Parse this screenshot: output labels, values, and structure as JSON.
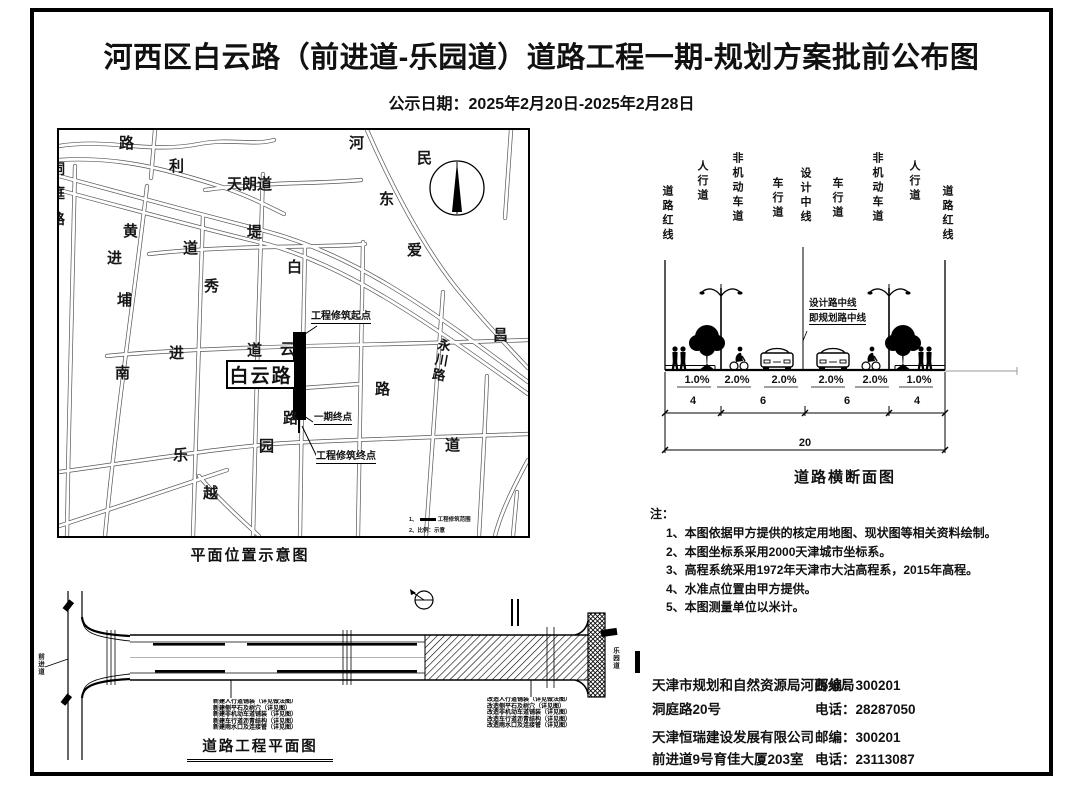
{
  "page": {
    "title": "河西区白云路（前进道-乐园道）道路工程一期-规划方案批前公布图",
    "publish_date": "公示日期：2025年2月20日-2025年2月28日"
  },
  "map": {
    "caption": "平面位置示意图",
    "highlight_label": "白云路",
    "start_label": "工程修筑起点",
    "phase1_end_label": "一期终点",
    "end_label": "工程修筑终点",
    "legend_no1": "1、",
    "legend_line1": "工程修筑范围",
    "legend_line2": "2、比例：示意",
    "vertical_road": "永川路",
    "street_chars": [
      {
        "t": "路",
        "x": 60,
        "y": 6
      },
      {
        "t": "利",
        "x": 110,
        "y": 29
      },
      {
        "t": "河",
        "x": 290,
        "y": 6
      },
      {
        "t": "民",
        "x": 358,
        "y": 21
      },
      {
        "t": "天朗道",
        "x": 168,
        "y": 47
      },
      {
        "t": "东",
        "x": 320,
        "y": 62
      },
      {
        "t": "黄",
        "x": 64,
        "y": 94
      },
      {
        "t": "堤",
        "x": 188,
        "y": 95
      },
      {
        "t": "道",
        "x": 124,
        "y": 111
      },
      {
        "t": "进",
        "x": 48,
        "y": 121
      },
      {
        "t": "白",
        "x": 228,
        "y": 130
      },
      {
        "t": "爱",
        "x": 348,
        "y": 113
      },
      {
        "t": "秀",
        "x": 145,
        "y": 149
      },
      {
        "t": "埔",
        "x": 58,
        "y": 163
      },
      {
        "t": "道",
        "x": 188,
        "y": 213
      },
      {
        "t": "云",
        "x": 221,
        "y": 212
      },
      {
        "t": "进",
        "x": 110,
        "y": 216
      },
      {
        "t": "南",
        "x": 56,
        "y": 236
      },
      {
        "t": "路",
        "x": 316,
        "y": 252
      },
      {
        "t": "昌",
        "x": 434,
        "y": 198
      },
      {
        "t": "路",
        "x": 224,
        "y": 281
      },
      {
        "t": "园",
        "x": 200,
        "y": 309
      },
      {
        "t": "乐",
        "x": 114,
        "y": 318
      },
      {
        "t": "道",
        "x": 386,
        "y": 308
      },
      {
        "t": "越",
        "x": 144,
        "y": 356
      }
    ],
    "clipped_chars": [
      {
        "t": "洞",
        "x": -8,
        "y": 32
      },
      {
        "t": "庭",
        "x": -8,
        "y": 56
      },
      {
        "t": "路",
        "x": -8,
        "y": 82
      }
    ]
  },
  "cross_section": {
    "caption": "道路横断面图",
    "lane_labels": [
      {
        "t": "道路红线",
        "x": 13,
        "y": 50
      },
      {
        "t": "人行道",
        "x": 48,
        "y": 25
      },
      {
        "t": "非机动车道",
        "x": 83,
        "y": 17
      },
      {
        "t": "车行道",
        "x": 123,
        "y": 42
      },
      {
        "t": "设计中线",
        "x": 151,
        "y": 32
      },
      {
        "t": "车行道",
        "x": 183,
        "y": 42
      },
      {
        "t": "非机动车道",
        "x": 223,
        "y": 17
      },
      {
        "t": "人行道",
        "x": 260,
        "y": 25
      },
      {
        "t": "道路红线",
        "x": 293,
        "y": 50
      }
    ],
    "centerline_note_1": "设计路中线",
    "centerline_note_2": "即规划路中线",
    "slopes": [
      {
        "t": "1.0%",
        "x": 32
      },
      {
        "t": "2.0%",
        "x": 72
      },
      {
        "t": "2.0%",
        "x": 119
      },
      {
        "t": "2.0%",
        "x": 166
      },
      {
        "t": "2.0%",
        "x": 210
      },
      {
        "t": "1.0%",
        "x": 254
      }
    ],
    "dims": [
      {
        "t": "4",
        "x": 28
      },
      {
        "t": "6",
        "x": 98
      },
      {
        "t": "6",
        "x": 182
      },
      {
        "t": "4",
        "x": 252
      }
    ],
    "total_dim": "20"
  },
  "notes": {
    "title": "注：",
    "items": [
      "1、本图依据甲方提供的核定用地图、现状图等相关资料绘制。",
      "2、本图坐标系采用2000天津城市坐标系。",
      "3、高程系统采用1972年天津市大沽高程系，2015年高程。",
      "4、水准点位置由甲方提供。",
      "5、本图测量单位以米计。"
    ]
  },
  "plan": {
    "caption": "道路工程平面图",
    "left_road": "前进道",
    "right_road": "乐园道",
    "block1": [
      "新建人行道铺装（详见做法图）",
      "新建侧平石及树穴（详见图）",
      "新建非机动车道铺装（详见图）",
      "新建车行道沥青结构（详见图）",
      "新建雨水口及连接管（详见图）"
    ],
    "block2": [
      "改造人行道铺装（详见做法图）",
      "改造侧平石及树穴（详见图）",
      "改造非机动车道铺装（详见图）",
      "改造车行道沥青结构（详见图）",
      "改造雨水口及连接管（详见图）"
    ]
  },
  "contacts": {
    "rows": [
      {
        "name": "天津市规划和自然资源局河西分局",
        "value": "邮编：300201",
        "y": 674
      },
      {
        "name": "洞庭路20号",
        "value": "电话：28287050",
        "y": 698
      },
      {
        "name": "天津恒瑞建设发展有限公司",
        "value": "邮编：300201",
        "y": 726
      },
      {
        "name": "前进道9号育佳大厦203室",
        "value": "电话：23113087",
        "y": 748
      }
    ]
  }
}
